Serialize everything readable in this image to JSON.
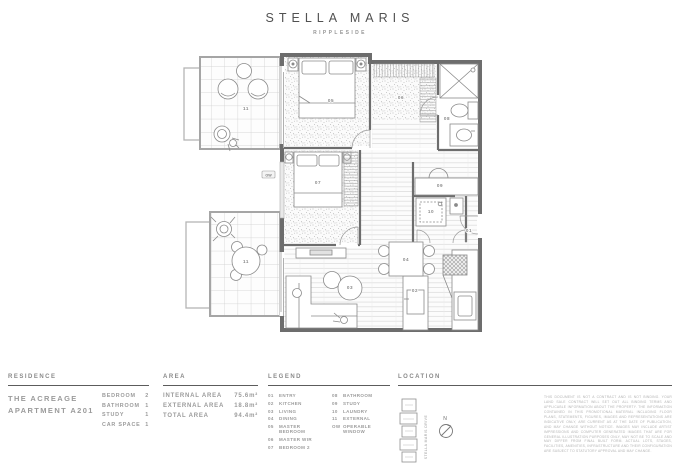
{
  "header": {
    "title": "STELLA MARIS",
    "subtitle": "RIPPLESIDE"
  },
  "plan": {
    "room_labels": {
      "entry": "01",
      "kitchen": "02",
      "living": "03",
      "dining": "04",
      "master_bedroom": "05",
      "master_wir": "06",
      "bedroom_2": "07",
      "bathroom": "08",
      "study": "09",
      "laundry": "10",
      "external_top": "11",
      "external_bottom": "11",
      "operable_window": "OW"
    }
  },
  "footer": {
    "residence": {
      "heading": "RESIDENCE",
      "name_line1": "THE ACREAGE",
      "name_line2": "APARTMENT A201",
      "stats": [
        {
          "label": "BEDROOM",
          "value": "2"
        },
        {
          "label": "BATHROOM",
          "value": "1"
        },
        {
          "label": "STUDY",
          "value": "1"
        },
        {
          "label": "CAR SPACE",
          "value": "1"
        }
      ]
    },
    "area": {
      "heading": "AREA",
      "rows": [
        {
          "label": "INTERNAL AREA",
          "value": "75.6m²"
        },
        {
          "label": "EXTERNAL AREA",
          "value": "18.8m²"
        },
        {
          "label": "TOTAL AREA",
          "value": "94.4m²"
        }
      ]
    },
    "legend": {
      "heading": "LEGEND",
      "col1": [
        {
          "code": "01",
          "label": "ENTRY"
        },
        {
          "code": "02",
          "label": "KITCHEN"
        },
        {
          "code": "03",
          "label": "LIVING"
        },
        {
          "code": "04",
          "label": "DINING"
        },
        {
          "code": "05",
          "label": "MASTER BEDROOM"
        },
        {
          "code": "06",
          "label": "MASTER WIR"
        },
        {
          "code": "07",
          "label": "BEDROOM 2"
        }
      ],
      "col2": [
        {
          "code": "08",
          "label": "BATHROOM"
        },
        {
          "code": "09",
          "label": "STUDY"
        },
        {
          "code": "10",
          "label": "LAUNDRY"
        },
        {
          "code": "11",
          "label": "EXTERNAL"
        },
        {
          "code": "OW",
          "label": "OPERABLE WINDOW"
        }
      ]
    },
    "location": {
      "heading": "LOCATION",
      "street_label": "STELLA MARIS DRIVE",
      "north_label": "N",
      "disclaimer": "THIS DOCUMENT IS NOT A CONTRACT AND IS NOT BINDING. YOUR LAND SALE CONTRACT WILL SET OUT ALL BINDING TERMS AND APPLICABLE INFORMATION ABOUT THE PROPERTY. THE INFORMATION CONTAINED IN THIS PROMOTIONAL MATERIAL INCLUDING FLOOR PLANS, STATEMENTS, FIGURES, IMAGES AND REPRESENTATIONS ARE INDICATIVE ONLY, ARE CURRENT AS AT THE DATE OF PUBLICATION, AND MAY CHANGE WITHOUT NOTICE. IMAGES MAY INCLUDE ARTIST IMPRESSIONS AND COMPUTER GENERATED IMAGES THAT ARE FOR GENERAL ILLUSTRATION PURPOSES ONLY, MAY NOT BE TO SCALE AND MAY DIFFER FROM FINAL BUILT FORM. ACTUAL LOTS, STAGES, FACILITIES, AMENITIES, INFRASTRUCTURE AND THEIR CONFIGURATION ARE SUBJECT TO STATUTORY APPROVAL AND MAY CHANGE."
    }
  }
}
